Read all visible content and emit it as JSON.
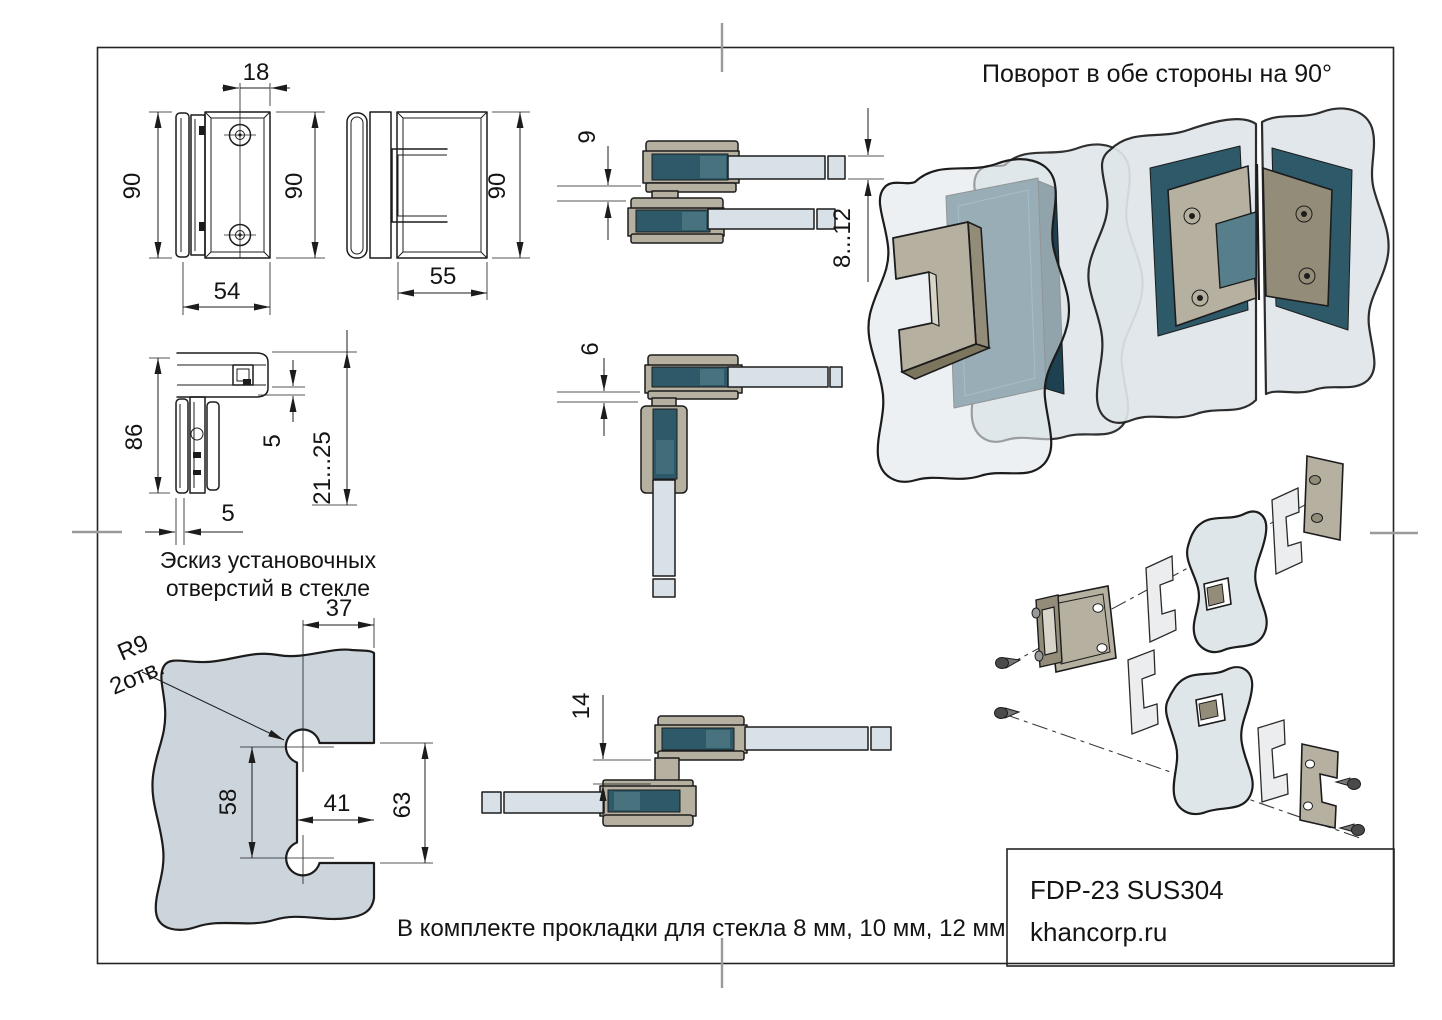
{
  "colors": {
    "outline": "#1c1c1c",
    "metal": "#b6b0a0",
    "metal_dark": "#938c79",
    "metal_light": "#d8d4c7",
    "glass_fill": "#ccd4dc",
    "glass_light": "#d8e1e8",
    "glass_3d": "#dfe6ea",
    "glass_dark": "#2d5968",
    "glass_dark2": "#1d4150",
    "glass_mid": "#567f8b",
    "gasket": "#ebedee",
    "mark": "#9a9a9a"
  },
  "notes": {
    "rotation": "Поворот в обе стороны на 90°",
    "gaskets": "В комплекте прокладки для стекла 8 мм, 10 мм, 12 мм"
  },
  "caption": {
    "line1": "Эскиз установочных",
    "line2": "отверстий в стекле"
  },
  "title_block": {
    "model": "FDP-23 SUS304",
    "website": "khancorp.ru"
  },
  "dims": {
    "front": {
      "hole_offset": "18",
      "height": "90",
      "height_right": "90",
      "width": "54"
    },
    "side": {
      "height": "90",
      "depth": "55"
    },
    "section": {
      "height": "86",
      "glass_gap": "5",
      "glass_edge": "21...25",
      "wall": "5"
    },
    "glass": {
      "hole_edge": "37",
      "radius": "R9",
      "holes": "2отв.",
      "hole_spacing": "58",
      "notch_depth": "41",
      "notch_height": "63"
    },
    "open180": {
      "center_gap": "9",
      "glass_thickness": "8...12"
    },
    "open90": {
      "gap": "6"
    },
    "offset180": {
      "offset": "14"
    }
  }
}
